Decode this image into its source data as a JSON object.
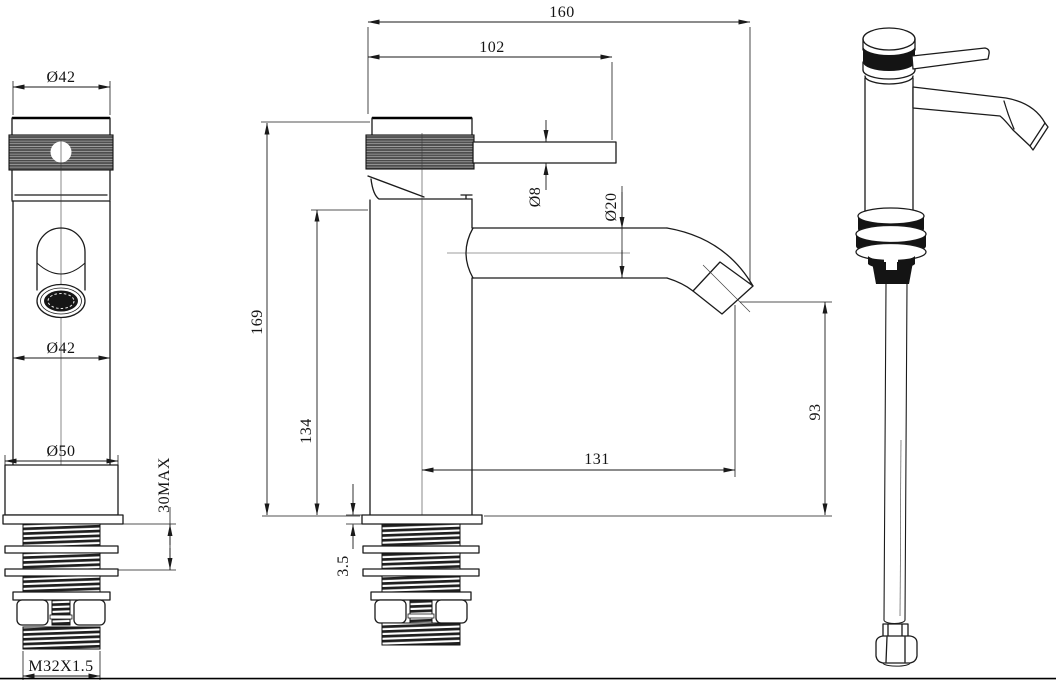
{
  "views": {
    "front": {
      "dims": {
        "cap_diameter": "Ø42",
        "body_diameter": "Ø42",
        "base_diameter": "Ø50",
        "max_deck_thickness": "30MAX",
        "shank_thread": "M32X1.5"
      }
    },
    "side": {
      "dims": {
        "overall_length": "160",
        "handle_length": "102",
        "handle_rod_diameter": "Ø8",
        "spout_tube_diameter": "Ø20",
        "overall_height": "169",
        "body_height": "134",
        "spout_reach": "131",
        "outlet_height": "93",
        "base_plate_thickness": "3.5"
      }
    }
  }
}
